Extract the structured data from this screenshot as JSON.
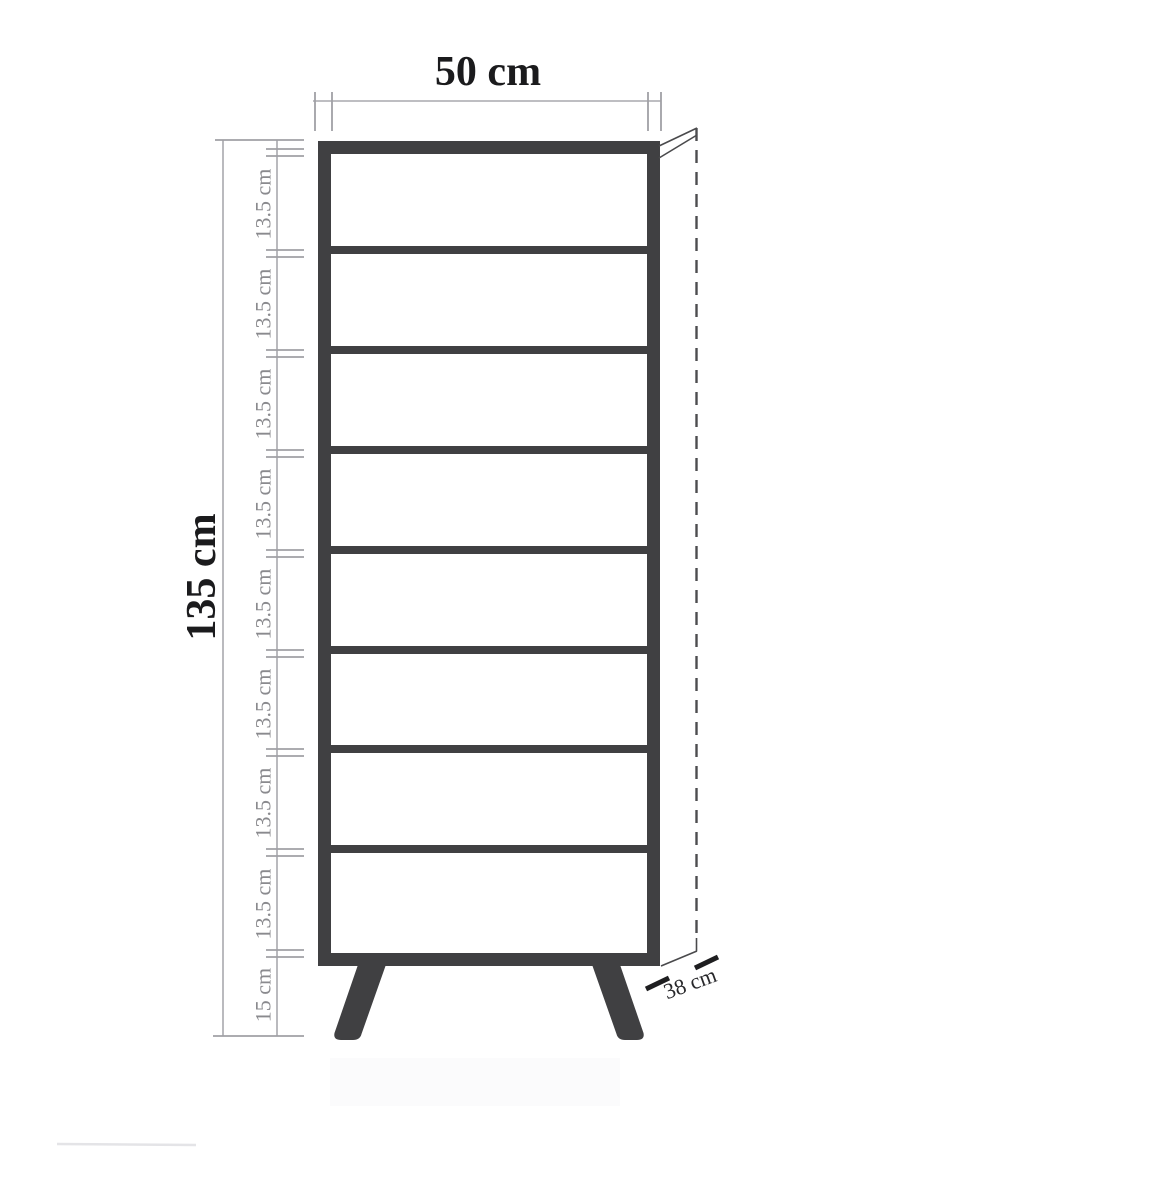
{
  "colors": {
    "background": "#ffffff",
    "frame": "#404042",
    "dimension_line": "#a9a9ad",
    "dimension_text_muted": "#8a8a8e",
    "dimension_text_strong": "#1b1b1d",
    "depth_line": "#4d4d4f",
    "depth_text": "#28282b"
  },
  "dimensions": {
    "width": {
      "label": "50 cm"
    },
    "height": {
      "label": "135 cm"
    },
    "depth": {
      "label": "38 cm"
    },
    "leg_height": {
      "label": "15 cm"
    },
    "shelf_segments": [
      {
        "label": "13.5 cm"
      },
      {
        "label": "13.5 cm"
      },
      {
        "label": "13.5 cm"
      },
      {
        "label": "13.5 cm"
      },
      {
        "label": "13.5 cm"
      },
      {
        "label": "13.5 cm"
      },
      {
        "label": "13.5 cm"
      },
      {
        "label": "13.5 cm"
      }
    ]
  },
  "structure": {
    "compartment_count": 8,
    "shelf_divider_count": 7,
    "leg_count": 2
  }
}
